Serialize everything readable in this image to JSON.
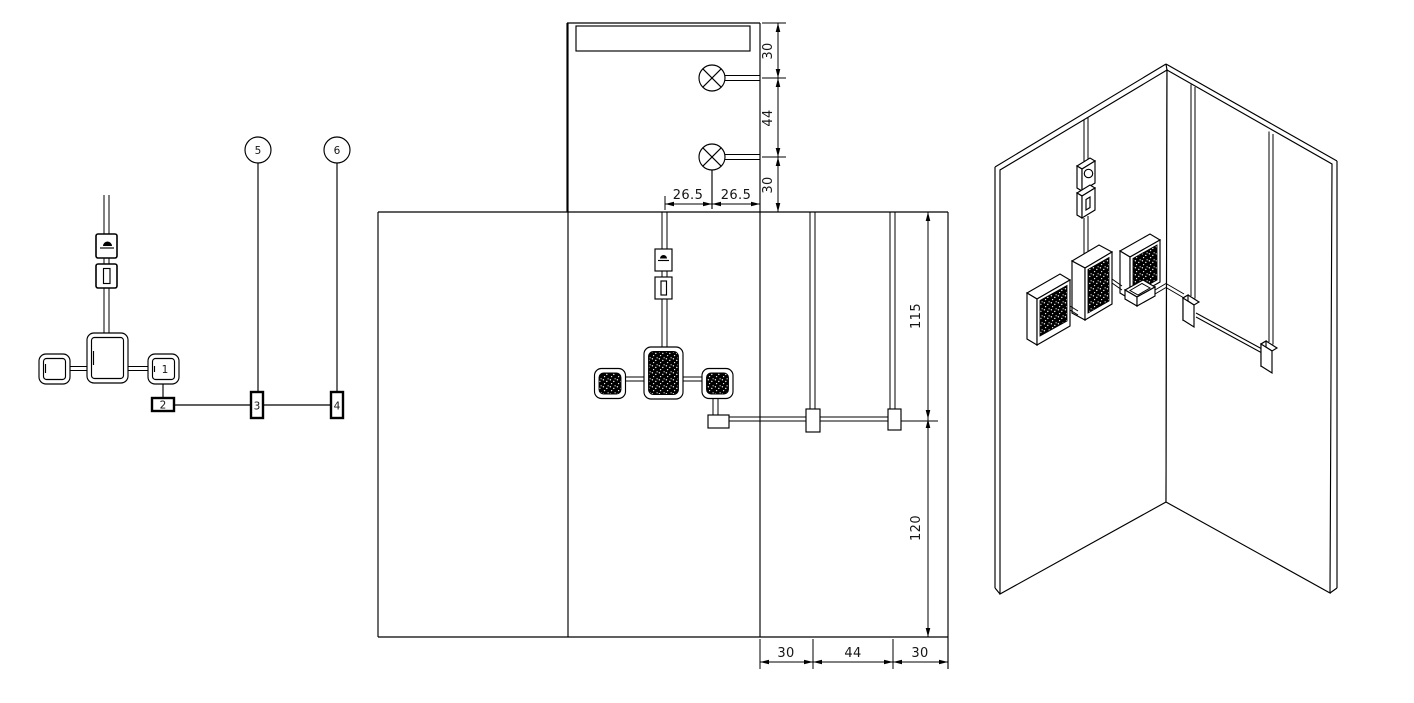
{
  "colors": {
    "background": "#ffffff",
    "line": "#000000"
  },
  "schematic": {
    "balloon_labels": [
      "5",
      "6"
    ],
    "box_labels": [
      "1",
      "2",
      "3",
      "4"
    ]
  },
  "plan": {
    "right_dims": [
      "30",
      "44",
      "30"
    ],
    "bottom_dims": [
      "26.5",
      "26.5"
    ]
  },
  "elevation": {
    "height_dims": [
      "115",
      "120"
    ],
    "bottom_dims": [
      "30",
      "44",
      "30"
    ]
  }
}
